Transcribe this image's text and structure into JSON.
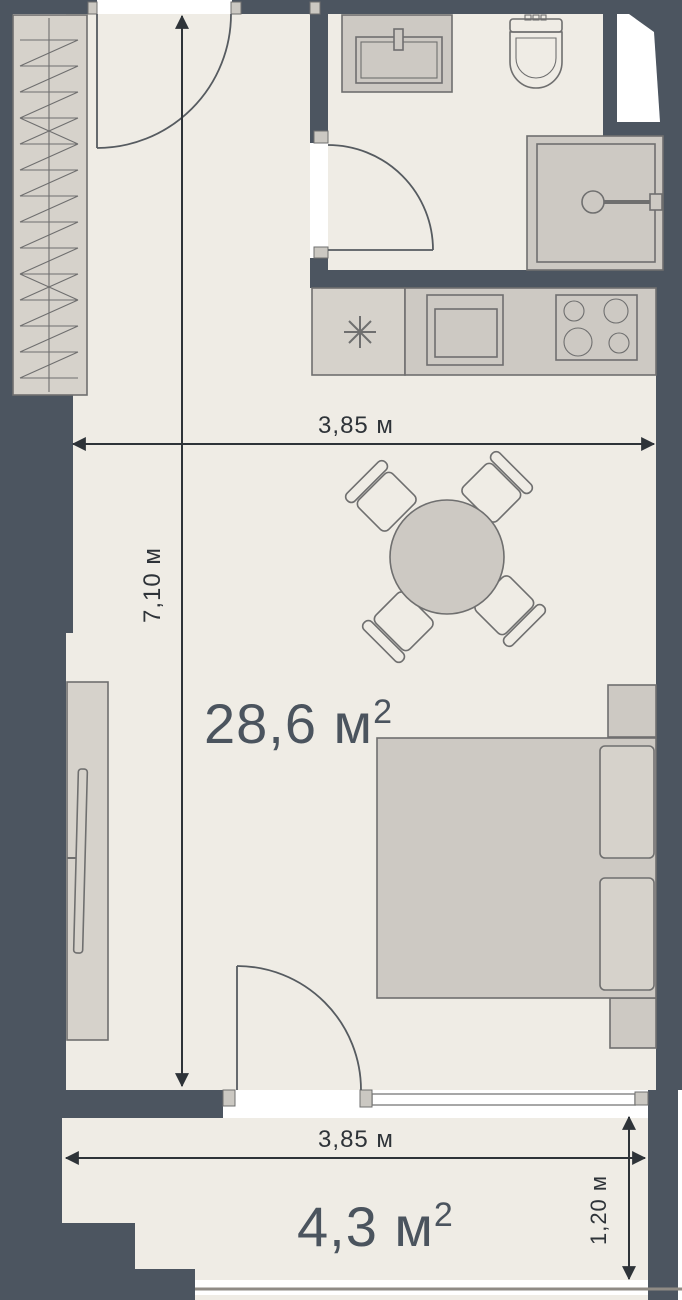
{
  "plan": {
    "living_area": {
      "value": "28,6 м",
      "sup": "2"
    },
    "balcony_area": {
      "value": "4,3 м",
      "sup": "2"
    },
    "dim_width_top": "3,85 м",
    "dim_height_left": "7,10 м",
    "dim_balcony_width": "3,85 м",
    "dim_balcony_depth": "1,20 м"
  },
  "colors": {
    "wall": "#4c5560",
    "floor": "#efece5",
    "furniture": "#cdc9c3",
    "furniture_light": "#d6d2cb",
    "outline": "#6f6f6f",
    "door": "#565b60",
    "dimension": "#2e3338",
    "label": "#4b545e",
    "jamb": "#cbc8c2",
    "railing": "#8f8b85",
    "window_line": "#8a8a8a"
  },
  "fixtures": {
    "bathroom": [
      "sink",
      "toilet",
      "shower"
    ],
    "kitchen": [
      "appliance-symbol",
      "oven",
      "cooktop"
    ],
    "living_room": [
      "wardrobe",
      "dining-table",
      "chairs",
      "bed",
      "pillows",
      "nightstands",
      "tv-stand",
      "tv"
    ],
    "balcony": [
      "railing"
    ]
  }
}
